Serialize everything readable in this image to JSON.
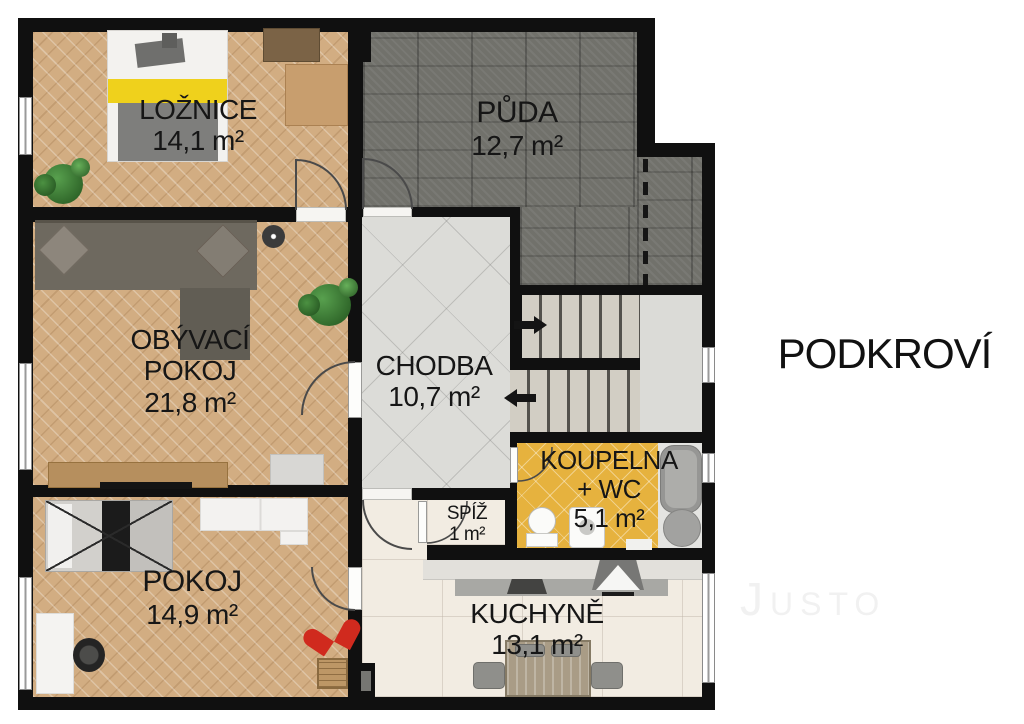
{
  "floor_plan": {
    "title": "PODKROVÍ",
    "watermark": "Justo"
  },
  "rooms": {
    "loznice": {
      "name": "LOŽNICE",
      "area": "14,1 m²"
    },
    "puda": {
      "name": "PŮDA",
      "area": "12,7 m²"
    },
    "obyvaci": {
      "name_line1": "OBÝVACÍ",
      "name_line2": "POKOJ",
      "area": "21,8 m²"
    },
    "chodba": {
      "name": "CHODBA",
      "area": "10,7 m²"
    },
    "koupelna": {
      "name_line1": "KOUPELNA",
      "name_line2": "+ WC",
      "area": "5,1 m²"
    },
    "spiz": {
      "name": "SPÍŽ",
      "area": "1 m²"
    },
    "kuchyne": {
      "name": "KUCHYNĚ",
      "area": "13,1 m²"
    },
    "pokoj": {
      "name": "POKOJ",
      "area": "14,9 m²"
    }
  },
  "palette": {
    "wall": "#101010",
    "parquet": "#d2ad82",
    "attic": "#71716b",
    "hallTile": "#dcdcd8",
    "kitchenFloor": "#f2ece2",
    "bathFloor": "#e6b23e",
    "tread": "#d2cec4",
    "landing": "#dbdbd7",
    "sofa": "#6e695f",
    "bedYellow": "#efd11c",
    "wood": "#b68f5e",
    "red": "#d02a1e",
    "green": "#3e7d38",
    "text": "#161616",
    "watermarkGray": "#f1f1f1"
  }
}
